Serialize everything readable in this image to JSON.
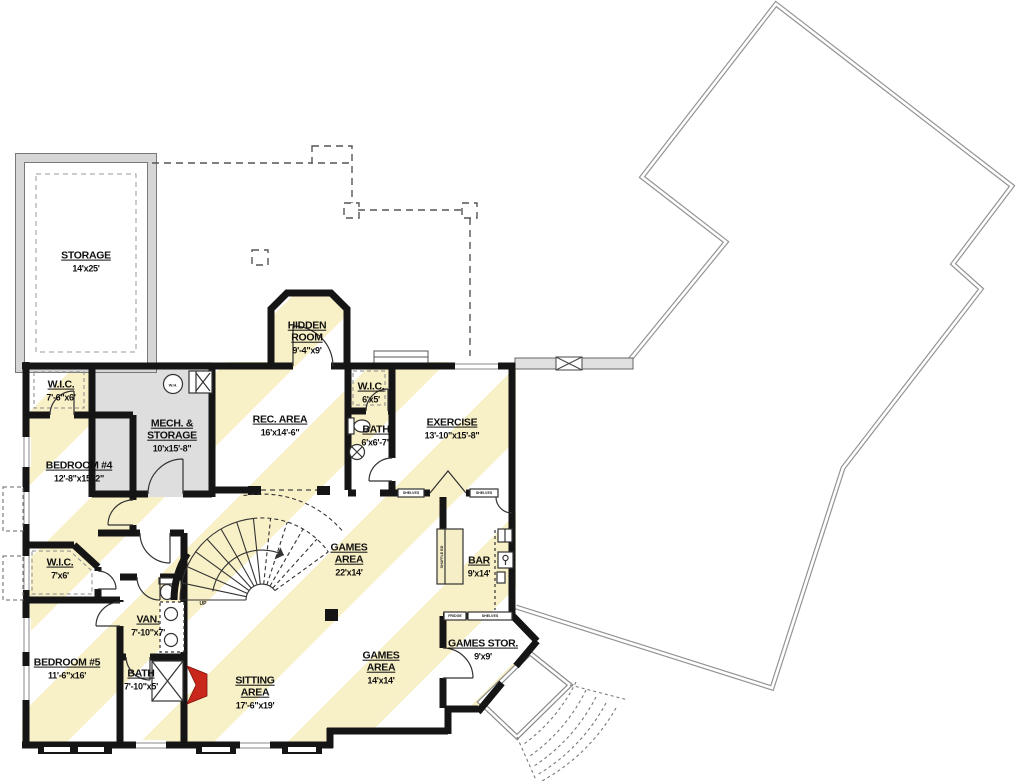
{
  "plan": {
    "title": "Basement Floor Plan",
    "colors": {
      "wall_black": "#151515",
      "stripe_yellow": "#f8f0c6",
      "mech_gray": "#dedede",
      "accent_red": "#c9271c",
      "deck_line": "#949494",
      "storage_band": "#d6d6d6"
    },
    "rooms": [
      {
        "id": "storage",
        "name": "STORAGE",
        "dims": "14'x25'",
        "x": 86,
        "y": 262
      },
      {
        "id": "hidden-room",
        "name": "HIDDEN\nROOM",
        "dims": "9'-4\"x9'",
        "x": 307,
        "y": 338
      },
      {
        "id": "wic-1",
        "name": "W.I.C.",
        "dims": "7'-6\"x6'",
        "x": 61,
        "y": 391
      },
      {
        "id": "mech-storage",
        "name": "MECH. &\nSTORAGE",
        "dims": "10'x15'-8\"",
        "x": 172,
        "y": 436
      },
      {
        "id": "rec-area",
        "name": "REC. AREA",
        "dims": "16'x14'-6\"",
        "x": 280,
        "y": 426
      },
      {
        "id": "wic-2",
        "name": "W.I.C.",
        "dims": "6'x5'",
        "x": 371,
        "y": 393
      },
      {
        "id": "bath-1",
        "name": "BATH",
        "dims": "6'x6'-7\"",
        "x": 376,
        "y": 436
      },
      {
        "id": "exercise",
        "name": "EXERCISE",
        "dims": "13'-10\"x15'-8\"",
        "x": 452,
        "y": 429
      },
      {
        "id": "bedroom-4",
        "name": "BEDROOM #4",
        "dims": "12'-8\"x15'-2\"",
        "x": 79,
        "y": 472
      },
      {
        "id": "games-area-1",
        "name": "GAMES\nAREA",
        "dims": "22'x14'",
        "x": 349,
        "y": 560
      },
      {
        "id": "bar",
        "name": "BAR",
        "dims": "9'x14'",
        "x": 479,
        "y": 567
      },
      {
        "id": "wic-3",
        "name": "W.I.C.",
        "dims": "7'x6'",
        "x": 60,
        "y": 569
      },
      {
        "id": "van",
        "name": "VAN.",
        "dims": "7'-10\"x7'",
        "x": 148,
        "y": 626
      },
      {
        "id": "bedroom-5",
        "name": "BEDROOM #5",
        "dims": "11'-6\"x16'",
        "x": 67,
        "y": 669
      },
      {
        "id": "bath-2",
        "name": "BATH",
        "dims": "7'-10\"x5'",
        "x": 141,
        "y": 680
      },
      {
        "id": "sitting-area",
        "name": "SITTING\nAREA",
        "dims": "17'-6\"x19'",
        "x": 255,
        "y": 693
      },
      {
        "id": "games-area-2",
        "name": "GAMES\nAREA",
        "dims": "14'x14'",
        "x": 381,
        "y": 668
      },
      {
        "id": "games-stor",
        "name": "GAMES STOR.",
        "dims": "9'x9'",
        "x": 483,
        "y": 650
      }
    ],
    "annotations": [
      {
        "id": "shelves-1",
        "text": "SHELVES",
        "x": 411,
        "y": 493,
        "size": 3.6,
        "rot": 0
      },
      {
        "id": "shelves-2",
        "text": "SHELVES",
        "x": 484,
        "y": 493,
        "size": 3.6,
        "rot": 0
      },
      {
        "id": "shelves-3",
        "text": "SHELVES",
        "x": 490,
        "y": 616,
        "size": 3.6,
        "rot": 0
      },
      {
        "id": "fridge",
        "text": "FRIDGE",
        "x": 455,
        "y": 616,
        "size": 3.6,
        "rot": 0
      },
      {
        "id": "water-heater",
        "text": "W.H.",
        "x": 173,
        "y": 385,
        "size": 4,
        "rot": 0
      },
      {
        "id": "stair-up",
        "text": "UP",
        "x": 203,
        "y": 604,
        "size": 5,
        "rot": 0
      },
      {
        "id": "shuffleboard",
        "text": "SHUFFLE BD",
        "x": 442,
        "y": 557,
        "size": 3.6,
        "rot": -90
      }
    ]
  }
}
